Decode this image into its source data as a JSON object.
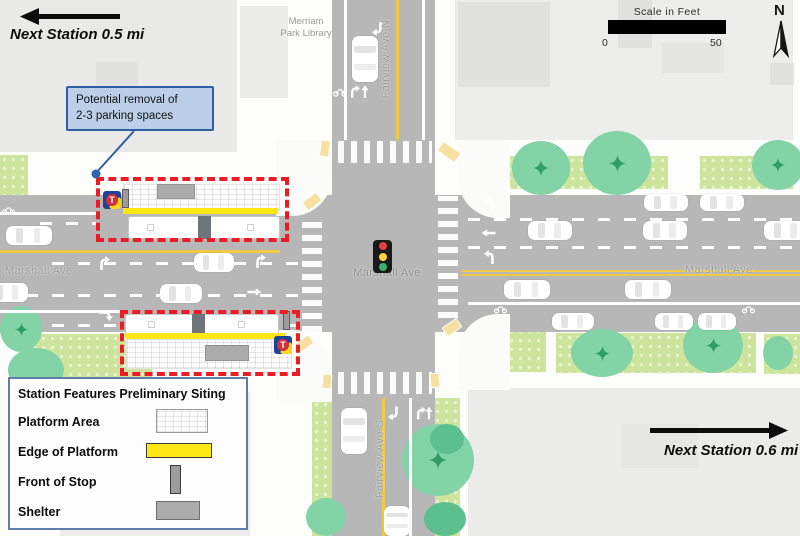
{
  "annotations": {
    "next_station_left": "Next Station 0.5 mi",
    "next_station_right": "Next Station 0.6 mi",
    "callout_line1": "Potential removal of",
    "callout_line2": "2-3 parking spaces"
  },
  "labels": {
    "library": "Merriam Park Library",
    "marshall_west": "Marshall Ave",
    "marshall_center": "Marshall Ave",
    "marshall_east": "Marshall Ave",
    "fairview_north": "Fairview Ave N",
    "fairview_south": "Fairview Ave S"
  },
  "scale_bar": {
    "title": "Scale in Feet",
    "min": "0",
    "max": "50"
  },
  "compass": {
    "label": "N"
  },
  "transit_logo": {
    "letter": "T"
  },
  "legend": {
    "title": "Station Features Preliminary Siting",
    "items": [
      {
        "label": "Platform Area",
        "swatch": "platform-hatch"
      },
      {
        "label": "Edge of Platform",
        "swatch": "yellow-bar"
      },
      {
        "label": "Front of Stop",
        "swatch": "gray-vertical-bar"
      },
      {
        "label": "Shelter",
        "swatch": "gray-rect"
      }
    ]
  },
  "icons": {
    "north_arrow": "compass-needle",
    "traffic_signal": "red-yellow-green-signal",
    "transit_logo": "metro-transit-T",
    "tree": "street-tree",
    "bus": "articulated-bus",
    "car": "car-top-view"
  },
  "colors": {
    "road": "#b7b7b7",
    "building": "#e9e9e7",
    "boulevard_green": "#cde49c",
    "tree_green": "#82d4a6",
    "platform_edge_yellow": "#ffe713",
    "red_dashed_outline": "#ec1c24",
    "callout_fill": "#bccfe8",
    "callout_border": "#2e5fa3",
    "transit_blue": "#21409a",
    "transit_red": "#d13239",
    "signal_red": "#e04040",
    "signal_yellow": "#ffd43a",
    "signal_green": "#37b26c"
  }
}
